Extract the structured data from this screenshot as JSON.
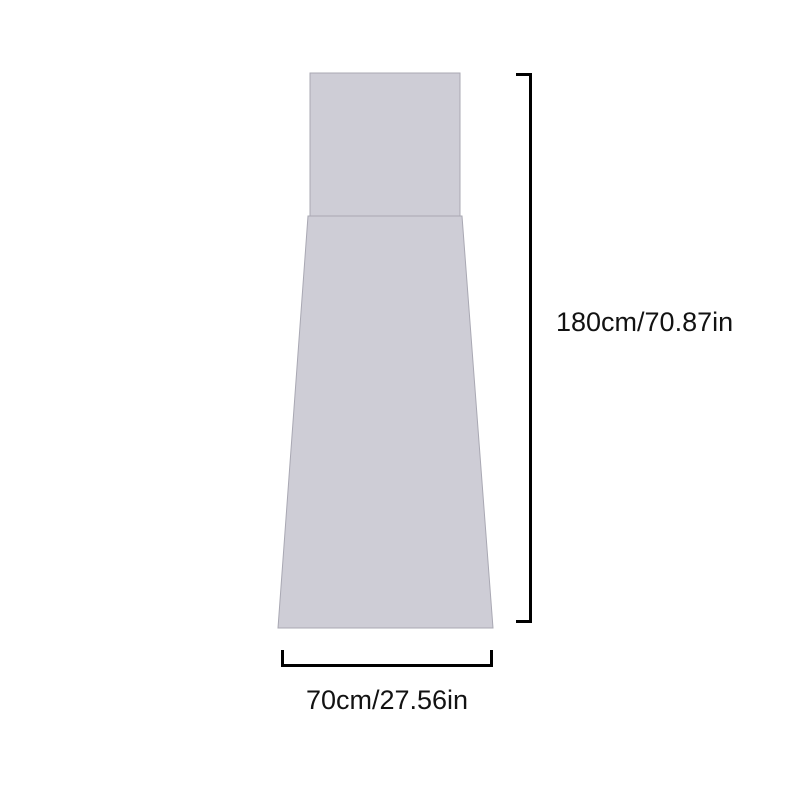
{
  "diagram": {
    "background": "#ffffff",
    "shape_fill": "#cecdd6",
    "shape_stroke": "#a9a8b3",
    "line_color": "#000000",
    "label_color": "#121212",
    "height_label": "180cm/70.87in",
    "width_label": "70cm/27.56in"
  }
}
